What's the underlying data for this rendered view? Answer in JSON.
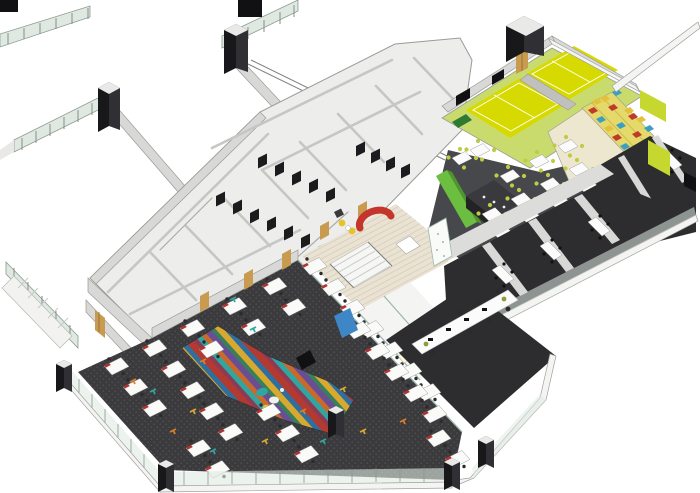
{
  "scene": {
    "kind": "axonometric-office-floor-plan-rendering",
    "width_px": 700,
    "height_px": 493
  },
  "colors": {
    "background": "#FFFFFF",
    "wall_fill": "#D8D8D6",
    "wall_edge": "#9A9A98",
    "wall_dark": "#B9B9B7",
    "floor_white": "#F4F4F2",
    "wing_floor": "#EDEDEB",
    "carpet": "#3B3B3E",
    "carpet_dot": "#55555A",
    "rug_stripes": [
      "#B23A30",
      "#2E6FA0",
      "#D9A92F",
      "#37805A",
      "#6A4E93",
      "#C96A2C",
      "#2FA7A0",
      "#8C3B57"
    ],
    "desk_top": "#FAFAF8",
    "desk_accent": "#B23230",
    "task_chair": "#2B2B2E",
    "scatter_teal": "#2FA7A0",
    "scatter_orange": "#D97E2B",
    "scatter_mustard": "#D9A92F",
    "wood_floor": "#EAE3D3",
    "wood_line": "#D8CEBB",
    "sofa_red": "#C4352B",
    "chair_yellow": "#E7C32A",
    "planter": "#3A3A3C",
    "blue_sofa": "#3F86C6",
    "accent_green": "#6CBE41",
    "accent_green_side": "#4F9430",
    "olive_panel": "#B3A93C",
    "counter_top": "#3A3A3E",
    "counter_front": "#232326",
    "cafeteria_floor": "#47484B",
    "cafe_table": "#FBFBFB",
    "cafe_chair": "#BFCB45",
    "court_yellow": "#D7DA00",
    "court_surround": "#CADB6E",
    "court_line": "#FFFFFF",
    "court_divider": "#C0C0BE",
    "lime_wall": "#C6D830",
    "bleacher": "#E4D96A",
    "cushion_red": "#C0392B",
    "cushion_blue": "#3B9EC4",
    "cushion_yellow": "#E3C23A",
    "cream_floor": "#EDE7CF",
    "dark_room": "#2D2D30",
    "room_table": "#FBFBFB",
    "corridor": "#DCDCDA",
    "cubicle_dark": "#1C1C1E",
    "door_wood": "#C89B4F",
    "door_wood_stripe": "#8A6A32",
    "glass": "#DFE9E1",
    "glass_frame": "#8A9A90",
    "glass_line": "#9FB8AE",
    "column_front": "#18181A",
    "column_side": "#303034",
    "column_top": "#E9E9E7",
    "bench_green": "#2F7A33",
    "black": "#111113",
    "white_table": "#FFFFFF"
  },
  "zones": [
    {
      "id": "open-plan-office",
      "label": "open plan office with bench desks"
    },
    {
      "id": "breakout-rug",
      "label": "multicoloured striped breakout rug"
    },
    {
      "id": "reception-lounge",
      "label": "reception lounge with red sofa"
    },
    {
      "id": "central-stair",
      "label": "central stair"
    },
    {
      "id": "meeting-rooms",
      "label": "glazed meeting rooms"
    },
    {
      "id": "boardroom",
      "label": "boardroom with long table"
    },
    {
      "id": "servery",
      "label": "servery counter with green feature wall"
    },
    {
      "id": "cafeteria",
      "label": "cafeteria seating"
    },
    {
      "id": "badminton-courts",
      "label": "two yellow badminton courts"
    },
    {
      "id": "tiered-seating",
      "label": "tiered seating with coloured cushions"
    },
    {
      "id": "east-meeting-rooms",
      "label": "dark meeting rooms, east end"
    },
    {
      "id": "training-rooms",
      "label": "training rooms along south facade"
    },
    {
      "id": "washroom-core",
      "label": "washroom and service core"
    },
    {
      "id": "access-bridges",
      "label": "external access bridges with glass railings"
    },
    {
      "id": "escape-stair",
      "label": "external escape stair, west"
    }
  ],
  "furniture": {
    "workstations": 33,
    "cafeteria_tables": 13,
    "boardroom_chairs": 10,
    "bleacher_cushions": 15,
    "badminton_courts": 2
  }
}
